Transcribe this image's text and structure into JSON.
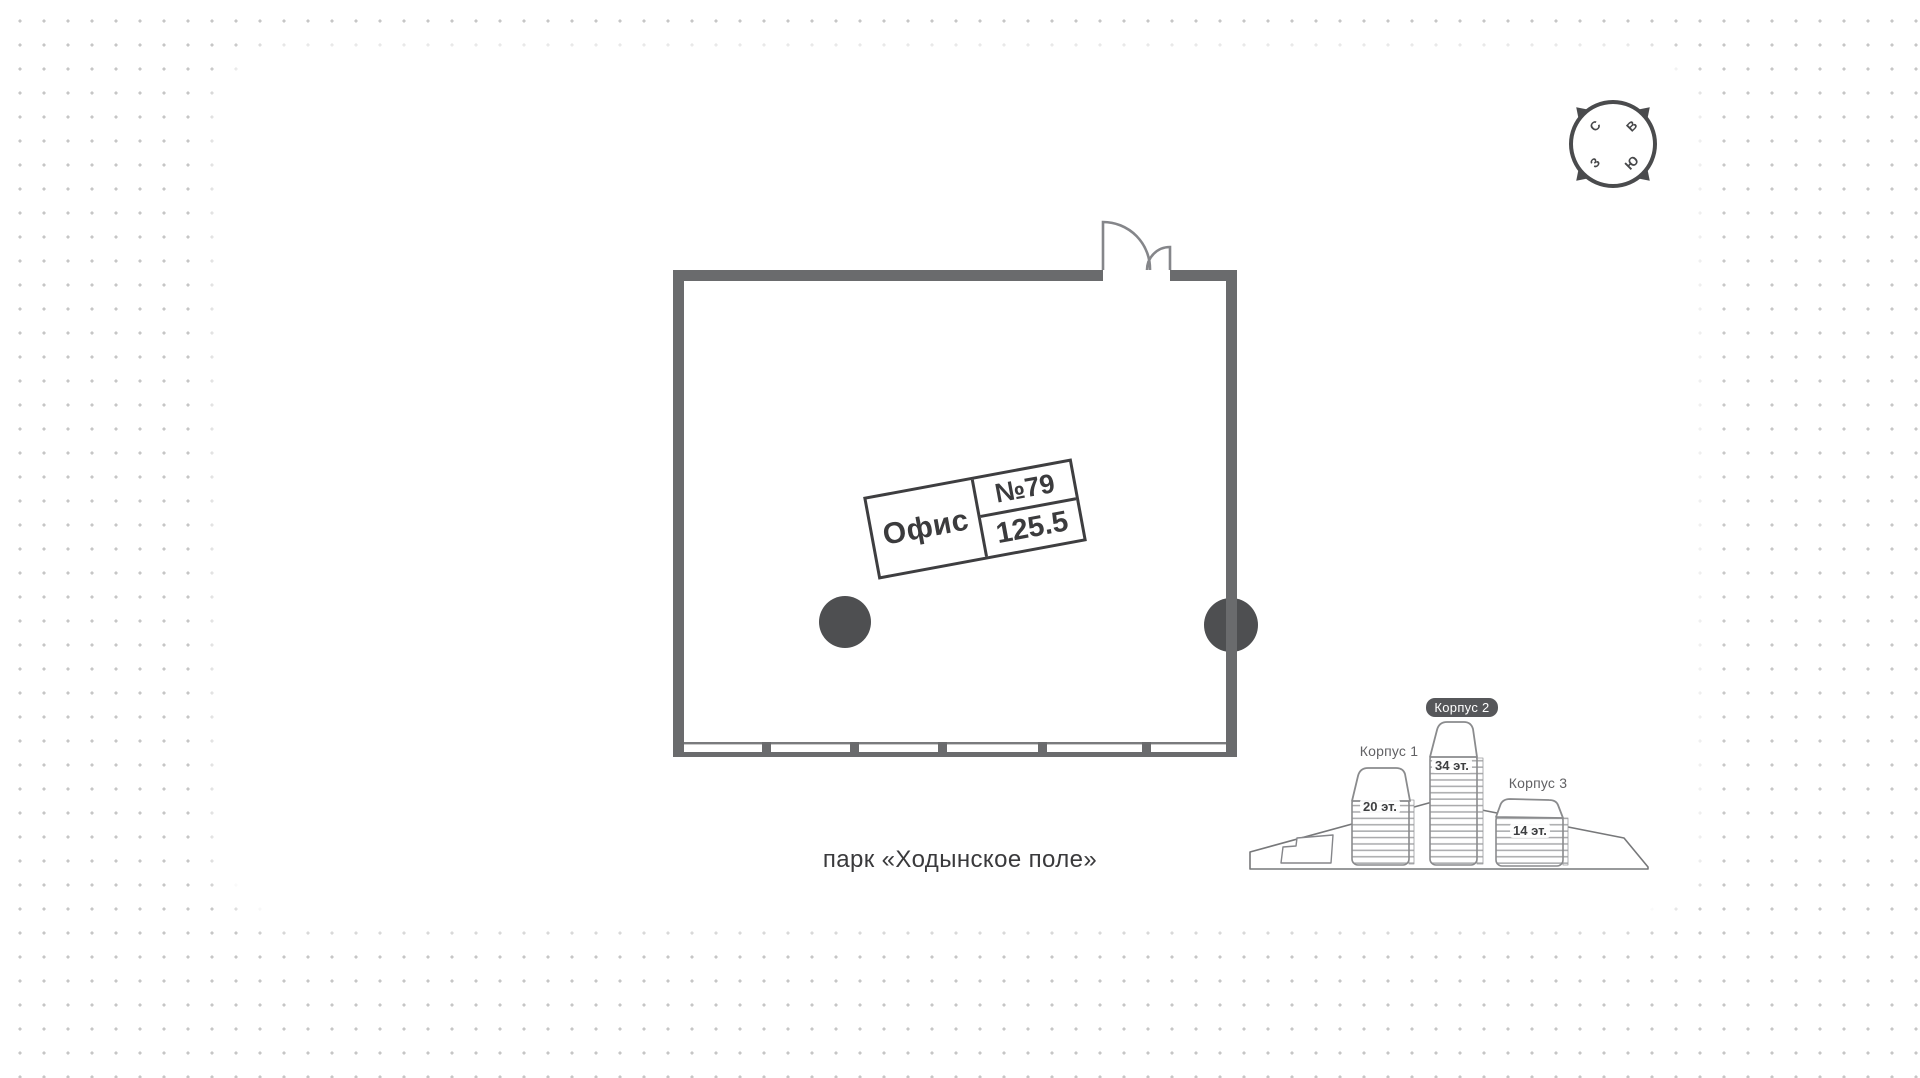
{
  "plan": {
    "unit_type_label": "Офис",
    "unit_number": "№79",
    "unit_area": "125.5"
  },
  "park_label": "парк «Ходынское поле»",
  "compass": {
    "north": "С",
    "east": "В",
    "south": "Ю",
    "west": "З"
  },
  "buildings": {
    "items": [
      {
        "name": "Корпус 1",
        "floors": "20 эт.",
        "highlighted": false
      },
      {
        "name": "Корпус 2",
        "floors": "34 эт.",
        "highlighted": true
      },
      {
        "name": "Корпус 3",
        "floors": "14 эт.",
        "highlighted": false
      }
    ]
  },
  "colors": {
    "wall": "#6a6b6d",
    "column": "#4e4f51",
    "outline": "#8a8b8d",
    "badge_bg": "#56575a",
    "dot": "#c6c6c6",
    "text_dark": "#3b3b3d"
  }
}
